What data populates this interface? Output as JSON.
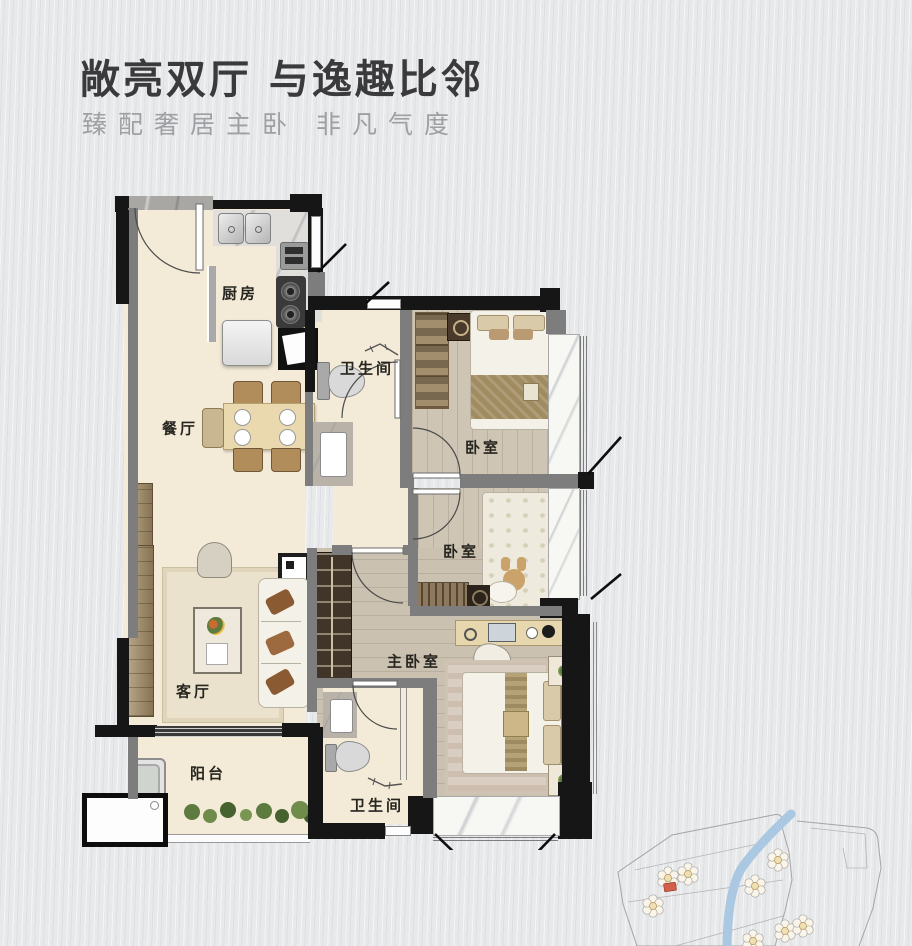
{
  "header": {
    "title": "敞亮双厅 与逸趣比邻",
    "subtitle": "臻配奢居主卧 非凡气度",
    "title_color": "#3a3a3d",
    "subtitle_color": "#9fa0a3"
  },
  "floorplan": {
    "rooms": [
      {
        "id": "kitchen",
        "label": "厨房"
      },
      {
        "id": "dining",
        "label": "餐厅"
      },
      {
        "id": "bath_top",
        "label": "卫生间"
      },
      {
        "id": "bedroom_top",
        "label": "卧室"
      },
      {
        "id": "bedroom_mid",
        "label": "卧室"
      },
      {
        "id": "living",
        "label": "客厅"
      },
      {
        "id": "master_bedroom",
        "label": "主卧室"
      },
      {
        "id": "balcony",
        "label": "阳台"
      },
      {
        "id": "bath_bottom",
        "label": "卫生间"
      }
    ],
    "colors": {
      "wall_dark": "#161616",
      "wall_gray": "#7d7d7d",
      "floor_cream": "#f3ead7",
      "floor_wood": "#cfc5b5",
      "window_sill": "#f7f7f4"
    }
  },
  "sitemap": {
    "river_color": "#aac8e2",
    "highlight_color": "#d2604a",
    "outline_color": "#a5a5a5"
  }
}
